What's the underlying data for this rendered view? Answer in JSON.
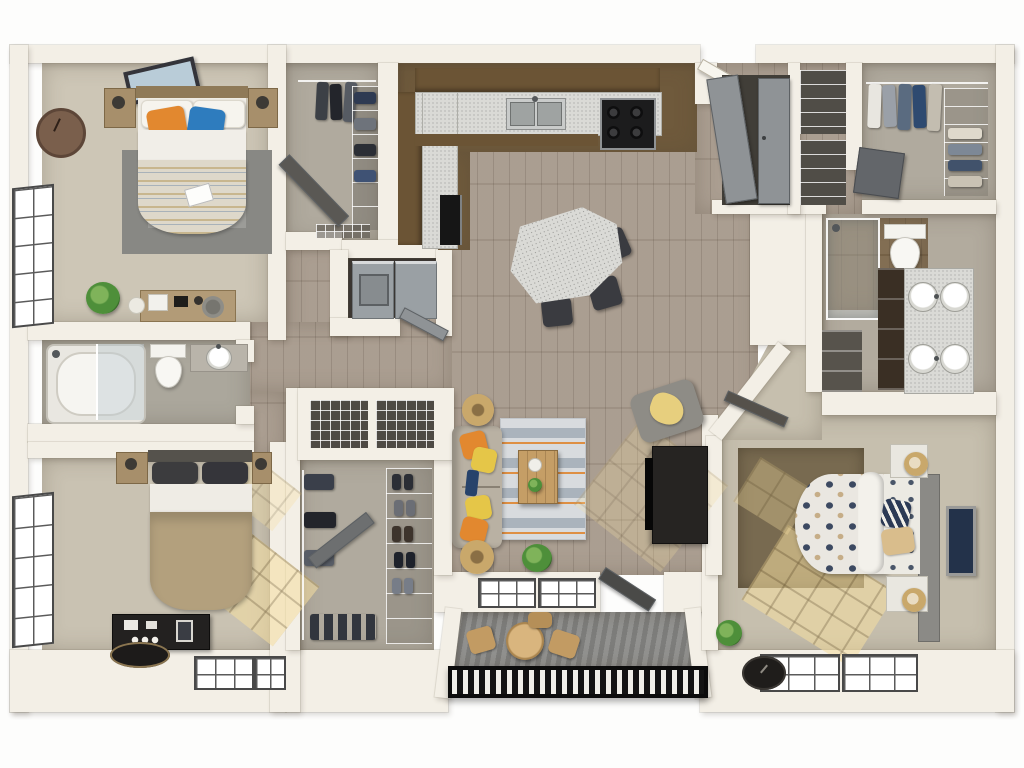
{
  "scene": {
    "kind": "3d-rendered floor plan, top-down view",
    "units": "2 bed + den / 3 sleeping rooms, 2 bathrooms, kitchen, living-dining, balcony, walk-in closets, laundry"
  },
  "colors": {
    "wall": "#f3efe6",
    "wood": "#a6998b",
    "kitchen_floor": "#6f5a3c",
    "carpet_bed1": "#cdc6b6",
    "carpet_bed2": "#c9c2b2",
    "carpet_master": "#c6bfae",
    "carpet_closet": "#b0aa9e",
    "bath_floor": "#aba79c",
    "bath2_floor": "#b2ab9e",
    "bath2_wood": "#7b664a",
    "deck": "#8c8c8a",
    "railing_dark": "#141414",
    "granite": "#dadad6",
    "cabinet_brown": "#6b5435",
    "door_gray": "#8f9396",
    "rug_gray": "#9c9c98",
    "rug_master": "#786a50",
    "rug_living_base": "#d6d9dc",
    "rug_living_stripe": "#a3adb6",
    "accent_orange": "#e2882f",
    "accent_blue": "#2e7cbe",
    "accent_yellow": "#e5c648",
    "accent_navy": "#2c3a55",
    "duvet_tan": "#b3a07d",
    "bed_white": "#efece5",
    "appliance_gray": "#9aa0a4",
    "dark_furniture": "#262422",
    "rattan": "#c9a86b",
    "plant": "#4e8f3a"
  },
  "rooms": [
    {
      "id": "bedroom-1",
      "name": "Bedroom 1 (top-left)",
      "floor": "carpet"
    },
    {
      "id": "closet-1",
      "name": "Closet 1",
      "floor": "carpet"
    },
    {
      "id": "kitchen",
      "name": "Kitchen",
      "floor": "dark wood"
    },
    {
      "id": "dining-living",
      "name": "Dining / Living Area",
      "floor": "wood plank"
    },
    {
      "id": "balcony",
      "name": "Balcony",
      "floor": "deck planks"
    },
    {
      "id": "bathroom-1",
      "name": "Bathroom 1",
      "floor": "tile"
    },
    {
      "id": "laundry",
      "name": "Laundry Closet",
      "floor": "dark"
    },
    {
      "id": "bedroom-2",
      "name": "Bedroom 2 (bottom-left)",
      "floor": "carpet"
    },
    {
      "id": "walk-in-closet",
      "name": "Walk-in Closet (center)",
      "floor": "carpet"
    },
    {
      "id": "hallway",
      "name": "Hallway",
      "floor": "carpet"
    },
    {
      "id": "corridor",
      "name": "Entry Corridor",
      "floor": "wood plank"
    },
    {
      "id": "storage-closets",
      "name": "Storage Closets",
      "floor": "wood plank"
    },
    {
      "id": "walk-in-closet-2",
      "name": "Walk-in Closet (top-right)",
      "floor": "carpet"
    },
    {
      "id": "bathroom-2",
      "name": "Master Bathroom",
      "floor": "tile + wood"
    },
    {
      "id": "master-bedroom",
      "name": "Master Bedroom (bottom-right)",
      "floor": "carpet"
    }
  ],
  "furniture": {
    "bedroom_1": [
      "queen-bed",
      "striped-duvet",
      "orange-pillow",
      "blue-pillow",
      "nightstand-x2",
      "table-lamp-x2",
      "area-rug",
      "wall-clock",
      "picture-frame",
      "window",
      "desk",
      "stool",
      "potted-plant"
    ],
    "closet_1": [
      "hanging-clothes",
      "wire-shelves",
      "folded-clothes",
      "open-door",
      "wire-basket"
    ],
    "kitchen": [
      "l-shaped-counter",
      "granite-countertop",
      "double-sink",
      "faucet",
      "range-stove-4-burners",
      "dishwasher",
      "brown-cabinets"
    ],
    "dining": [
      "granite-dining-table",
      "dining-chair-x3"
    ],
    "living": [
      "sofa",
      "throw-pillows-orange-yellow",
      "patterned-area-rug",
      "wood-coffee-table",
      "round-side-table-x2",
      "potted-plant",
      "tv-console",
      "tv",
      "armchair",
      "yellow-throw",
      "window"
    ],
    "balcony": [
      "round-patio-table",
      "patio-chair-x3",
      "black-railing"
    ],
    "bathroom_1": [
      "bathtub-shower-glass",
      "toilet",
      "vanity-sink",
      "faucet"
    ],
    "laundry": [
      "washer",
      "dryer"
    ],
    "bedroom_2": [
      "bed",
      "tan-duvet",
      "dark-pillows",
      "nightstand-x2",
      "table-lamp-x2",
      "black-desk",
      "vanity-items",
      "oval-rug",
      "window-x2",
      "sunlight-patches"
    ],
    "walk_in_closet": [
      "built-in-shelf-wire-baskets",
      "hanging-clothes",
      "shoe-rack",
      "shoes",
      "open-door"
    ],
    "storage": [
      "double-door-cabinet",
      "wire-shelf-closet-x2"
    ],
    "walk_in_closet_2": [
      "hanging-clothes-rod",
      "folded-clothes-stacks",
      "dresser"
    ],
    "bathroom_2": [
      "glass-shower",
      "toilet",
      "double-vanity",
      "round-sink-x4",
      "drawer-tower",
      "linen-nook"
    ],
    "master_bedroom": [
      "bed",
      "polka-dot-duvet",
      "navy-striped-pillow",
      "tan-pillow",
      "gray-headboard",
      "nightstand-x2",
      "woven-lamp-x2",
      "dark-area-rug",
      "picture-frame",
      "window-x2",
      "wall-clock",
      "potted-plant",
      "sunlight-patches"
    ]
  }
}
